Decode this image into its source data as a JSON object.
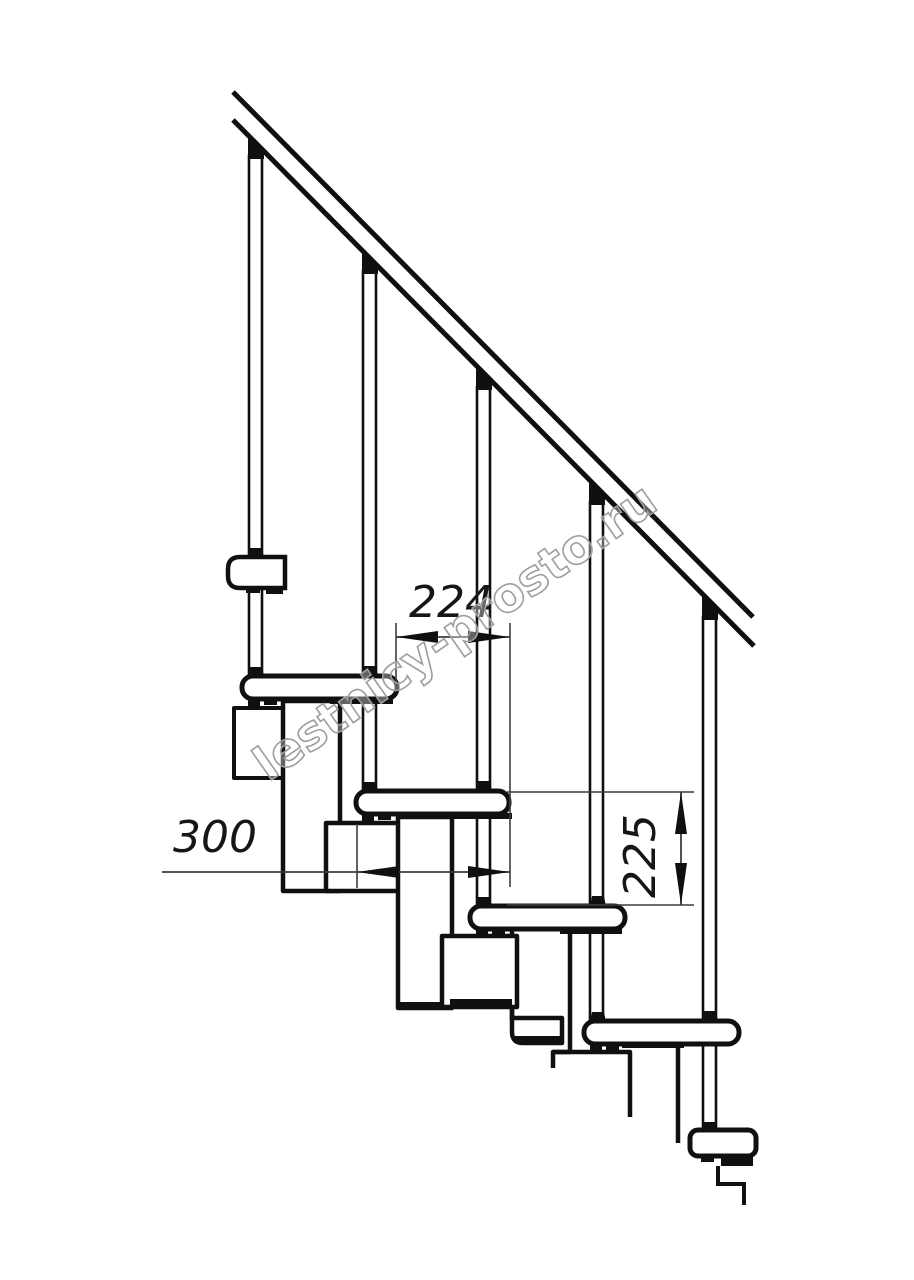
{
  "drawing": {
    "type": "staircase-side-elevation",
    "watermark": "lestnicy-prosto.ru",
    "dimensions": {
      "step_run": {
        "value": "224",
        "orientation": "horizontal"
      },
      "tread_depth": {
        "value": "300",
        "orientation": "horizontal"
      },
      "riser_height": {
        "value": "225",
        "orientation": "vertical"
      }
    },
    "colors": {
      "line": "#101010",
      "dimension_line": "#3d3d3d",
      "dimension_text": "#161616",
      "watermark_outline": "#9e9e9e",
      "background": "#ffffff"
    },
    "counts": {
      "balusters": 5,
      "treads": 4
    }
  }
}
